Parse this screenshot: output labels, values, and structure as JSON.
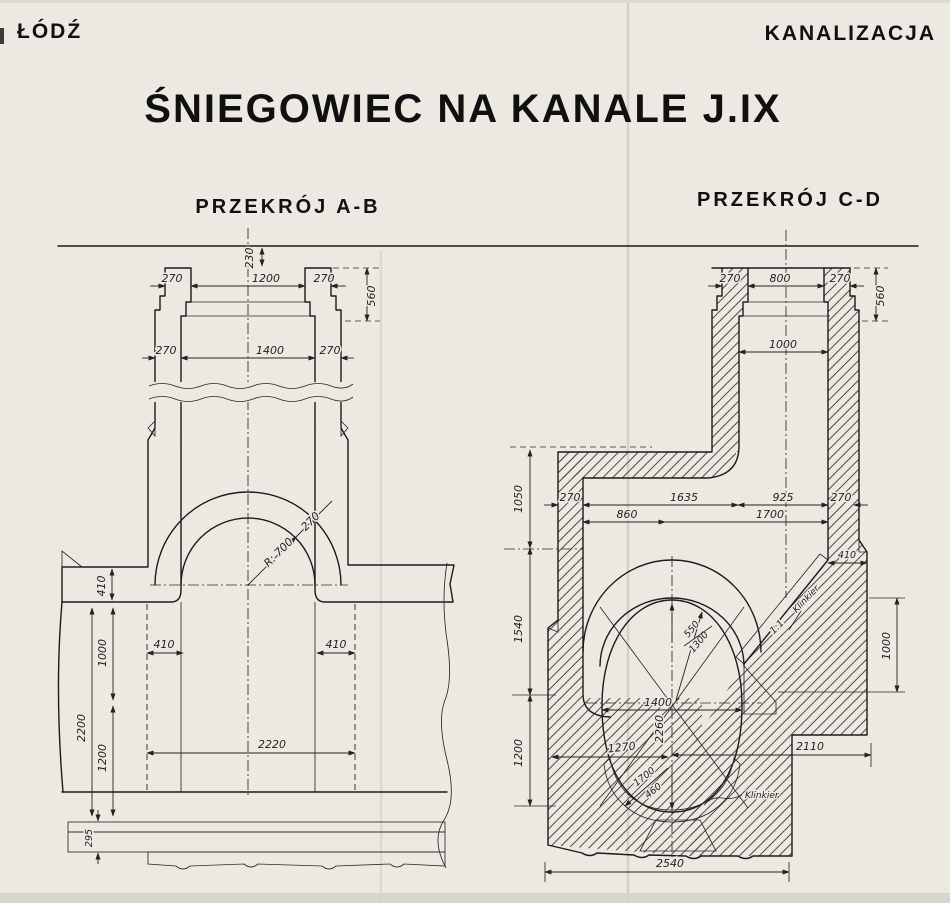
{
  "header": {
    "left": "ŁÓDŹ",
    "right": "KANALIZACJA"
  },
  "title": "ŚNIEGOWIEC NA KANALE J.IX",
  "section_ab": {
    "label": "PRZEKRÓJ A-B",
    "dims": {
      "top_cover": "230",
      "collar_wall_l": "270",
      "collar_width": "1200",
      "collar_wall_r": "270",
      "collar_height": "560",
      "shaft_wall_l": "270",
      "shaft_width": "1400",
      "shaft_wall_r": "270",
      "arch_radius": "R: 700",
      "arch_ring": "270",
      "slab_thk": "410",
      "ledge_l": "410",
      "ledge_r": "410",
      "depth_upper": "1000",
      "depth_lower": "1200",
      "depth_total": "2200",
      "width_lower": "2220",
      "base_thk": "295"
    }
  },
  "section_cd": {
    "label": "PRZEKRÓJ C-D",
    "dims": {
      "collar_wall_l": "270",
      "collar_width": "800",
      "collar_wall_r": "270",
      "collar_height": "560",
      "shaft_width": "1000",
      "depth_roof": "1050",
      "depth_mid": "1540",
      "depth_lower": "1200",
      "wall_l": "270",
      "span_l": "1635",
      "span_r": "925",
      "wall_r": "270",
      "offset_l": "860",
      "offset_r": "1700",
      "wall_thk": "410",
      "slope_h": "1000",
      "r_top": "550",
      "r_mid": "1300",
      "slope_ratio": "1:1",
      "lining_slope": "Klinkier",
      "width": "1400",
      "height": "2260",
      "r_side": "1270",
      "r_low": "1700",
      "r_invert": "460",
      "lining_invert": "Klinkier",
      "offset_base": "2110",
      "base_width": "2540"
    }
  },
  "colors": {
    "paper": "#ece9e2",
    "ink": "#1b1b1b"
  }
}
